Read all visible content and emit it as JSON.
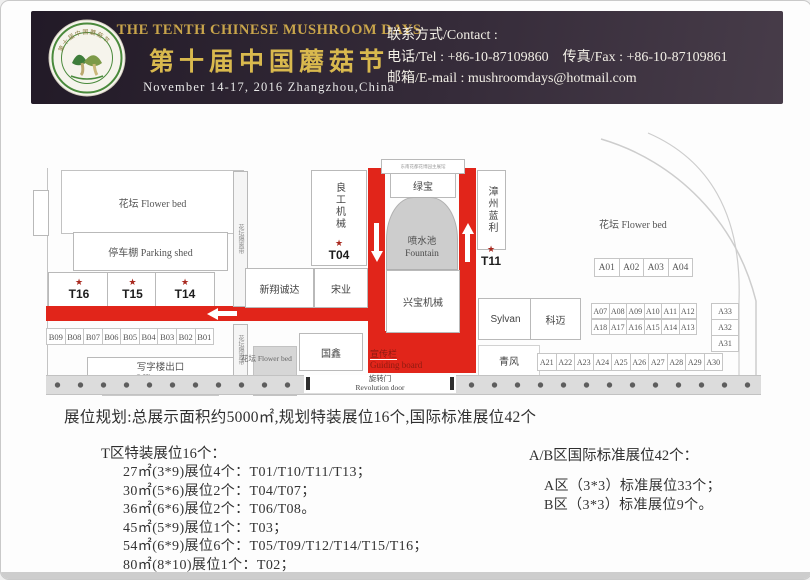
{
  "header": {
    "title_en": "THE TENTH CHINESE MUSHROOM DAYS",
    "title_cn": "第十届中国蘑菇节",
    "date_line": "November 14-17, 2016  Zhangzhou,China",
    "contact_label": "联系方式/Contact :",
    "tel_fax_line": "电话/Tel : +86-10-87109860　传真/Fax : +86-10-87109861",
    "email_line": "邮箱/E-mail : mushroomdays@hotmail.com",
    "colors": {
      "gold": "#d9b94e",
      "background": "#2a2130",
      "road_red": "#e1251a"
    }
  },
  "map": {
    "flower_bed_left": "花坛  Flower bed",
    "flower_bed_right": "花坛  Flower bed",
    "flower_bed_small": "花坛 Flower bed",
    "parking_shed": "停车棚  Parking shed",
    "office_export_cn": "写字楼出口",
    "office_export_en": "Office export",
    "isolation_strip": "花坛隔离带",
    "star": "★",
    "t_booths_left": [
      "T16",
      "T15",
      "T14"
    ],
    "b_row": [
      "B09",
      "B08",
      "B07",
      "B06",
      "B05",
      "B04",
      "B03",
      "B02",
      "B01"
    ],
    "lianggong": "良工机械",
    "t04": "T04",
    "xinxiang": "新翔诚达",
    "songye": "宋业",
    "guoxin": "国鑫",
    "tiny_strip": "东南花都花博园主展馆",
    "lvbao": "绿宝",
    "fountain_cn": "喷水池",
    "fountain_en": "Fountain",
    "xingbao": "兴宝机械",
    "guiding_cn": "宣传栏",
    "guiding_en": "Guiding board",
    "zhangzhou": "漳州蓝利",
    "t11": "T11",
    "sylvan": "Sylvan",
    "kemai": "科迈",
    "qingfeng": "青风",
    "a_row_top": [
      "A01",
      "A02",
      "A03",
      "A04"
    ],
    "a_row_mid1": [
      "A07",
      "A08",
      "A09",
      "A10",
      "A11",
      "A12"
    ],
    "a_row_mid2": [
      "A18",
      "A17",
      "A16",
      "A15",
      "A14",
      "A13"
    ],
    "a_col_right": [
      "A33",
      "A32",
      "A31"
    ],
    "a_row_bottom": [
      "A21",
      "A22",
      "A23",
      "A24",
      "A25",
      "A26",
      "A27",
      "A28",
      "A29",
      "A30"
    ],
    "door_cn": "旋转门",
    "door_en": "Revolution door"
  },
  "summary": {
    "headline": "展位规划:总展示面积约5000㎡,规划特装展位16个,国际标准展位42个",
    "t_header": "T区特装展位16个：",
    "ab_header": "A/B区国际标准展位42个：",
    "t_items": [
      "27㎡(3*9)展位4个：T01/T10/T11/T13；",
      "30㎡(5*6)展位2个：T04/T07；",
      "36㎡(6*6)展位2个：T06/T08。",
      "45㎡(5*9)展位1个：T03；",
      "54㎡(6*9)展位6个：T05/T09/T12/T14/T15/T16；",
      "80㎡(8*10)展位1个：T02；"
    ],
    "ab_items": [
      "A区（3*3）标准展位33个；",
      "B区（3*3）标准展位9个。"
    ]
  }
}
